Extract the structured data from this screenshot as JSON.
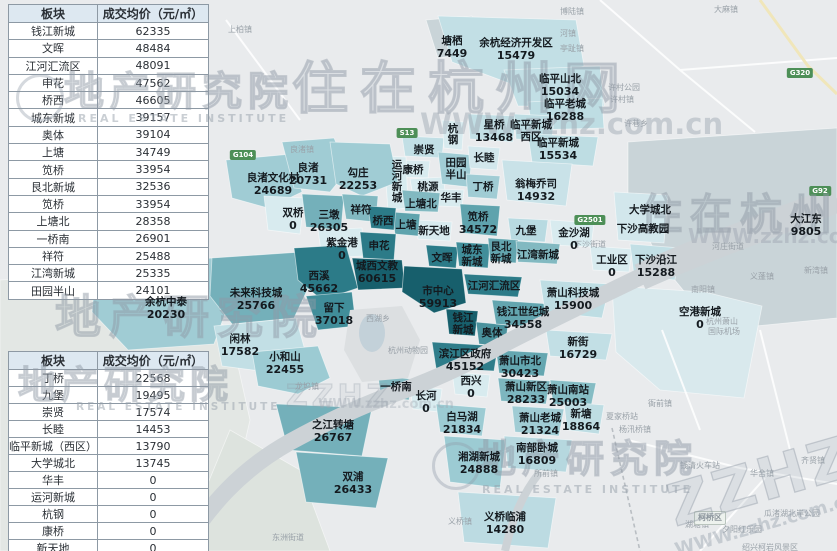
{
  "watermark": {
    "brand_cn": "住在杭州网",
    "brand_abbr": "ZZHZ",
    "brand_url": "WWW.zzhz.com.cn",
    "institute_cn": "地产研究院",
    "institute_en": "REAL ESTATE INSTITUTE"
  },
  "price_tables": [
    {
      "headers": [
        "板块",
        "成交均价（元/㎡）"
      ],
      "rows": [
        [
          "钱江新城",
          "62335"
        ],
        [
          "文晖",
          "48484"
        ],
        [
          "江河汇流区",
          "48091"
        ],
        [
          "申花",
          "47562"
        ],
        [
          "桥西",
          "46605"
        ],
        [
          "城东新城",
          "39157"
        ],
        [
          "奥体",
          "39104"
        ],
        [
          "上塘",
          "34749"
        ],
        [
          "笕桥",
          "33954"
        ],
        [
          "艮北新城",
          "32536"
        ],
        [
          "笕桥",
          "33954"
        ],
        [
          "上塘北",
          "28358"
        ],
        [
          "一桥南",
          "26901"
        ],
        [
          "祥符",
          "25488"
        ],
        [
          "江湾新城",
          "25335"
        ],
        [
          "田园半山",
          "24101"
        ]
      ]
    },
    {
      "headers": [
        "板块",
        "成交均价（元/㎡）"
      ],
      "rows": [
        [
          "丁桥",
          "22568"
        ],
        [
          "九堡",
          "19495"
        ],
        [
          "崇贤",
          "17574"
        ],
        [
          "长睦",
          "14453"
        ],
        [
          "临平新城（西区）",
          "13790"
        ],
        [
          "大学城北",
          "13745"
        ],
        [
          "华丰",
          "0"
        ],
        [
          "运河新城",
          "0"
        ],
        [
          "杭钢",
          "0"
        ],
        [
          "康桥",
          "0"
        ],
        [
          "新天地",
          "0"
        ],
        [
          "桃源",
          "0"
        ]
      ]
    }
  ],
  "map_labels": [
    {
      "n": "塘栖",
      "v": "7449",
      "x": 452,
      "y": 36
    },
    {
      "n": "余杭经济开发区",
      "v": "15479",
      "x": 516,
      "y": 38
    },
    {
      "n": "临平山北",
      "v": "15034",
      "x": 560,
      "y": 74
    },
    {
      "n": "临平老城",
      "v": "16288",
      "x": 565,
      "y": 99
    },
    {
      "n": "星桥",
      "v": "13468",
      "x": 494,
      "y": 120
    },
    {
      "n": "临平新城",
      "n2": "西区",
      "x": 531,
      "y": 120
    },
    {
      "n": "临平新城",
      "v": "15534",
      "x": 558,
      "y": 138
    },
    {
      "n": "翁梅乔司",
      "v": "14932",
      "x": 536,
      "y": 179
    },
    {
      "n": "崇贤",
      "x": 424,
      "y": 145
    },
    {
      "n": "杭钢",
      "vert": true,
      "x": 447,
      "y": 124
    },
    {
      "n": "田园",
      "n2": "半山",
      "x": 456,
      "y": 158
    },
    {
      "n": "长睦",
      "x": 484,
      "y": 153
    },
    {
      "n": "康桥",
      "x": 413,
      "y": 165
    },
    {
      "n": "桃源",
      "x": 428,
      "y": 182
    },
    {
      "n": "运河新城",
      "vert": true,
      "x": 391,
      "y": 160
    },
    {
      "n": "上塘北",
      "x": 421,
      "y": 199
    },
    {
      "n": "华丰",
      "x": 451,
      "y": 193
    },
    {
      "n": "丁桥",
      "x": 483,
      "y": 182
    },
    {
      "n": "上塘",
      "x": 406,
      "y": 220
    },
    {
      "n": "新天地",
      "x": 434,
      "y": 226
    },
    {
      "n": "笕桥",
      "v": "34572",
      "x": 478,
      "y": 212
    },
    {
      "n": "双桥",
      "v": "0",
      "x": 293,
      "y": 208
    },
    {
      "n": "三墩",
      "v": "26305",
      "x": 329,
      "y": 210
    },
    {
      "n": "祥符",
      "x": 361,
      "y": 205
    },
    {
      "n": "桥西",
      "x": 383,
      "y": 216
    },
    {
      "n": "紫金港",
      "v": "0",
      "x": 342,
      "y": 238
    },
    {
      "n": "申花",
      "x": 379,
      "y": 241
    },
    {
      "n": "良渚文化村",
      "v": "24689",
      "x": 273,
      "y": 173
    },
    {
      "n": "良渚",
      "v": "20731",
      "x": 308,
      "y": 163
    },
    {
      "n": "勾庄",
      "v": "22253",
      "x": 358,
      "y": 168
    },
    {
      "n": "西溪",
      "v": "45662",
      "x": 319,
      "y": 271
    },
    {
      "n": "城西文教",
      "v": "60615",
      "x": 377,
      "y": 261
    },
    {
      "n": "文晖",
      "x": 442,
      "y": 253
    },
    {
      "n": "城东",
      "n2": "新城",
      "x": 472,
      "y": 245
    },
    {
      "n": "艮北",
      "n2": "新城",
      "x": 501,
      "y": 242
    },
    {
      "n": "江湾新城",
      "x": 538,
      "y": 250
    },
    {
      "n": "九堡",
      "x": 526,
      "y": 226
    },
    {
      "n": "金沙湖",
      "v": "0",
      "x": 574,
      "y": 228
    },
    {
      "n": "市中心",
      "v": "59913",
      "x": 438,
      "y": 286
    },
    {
      "n": "江河汇流区",
      "x": 494,
      "y": 281
    },
    {
      "n": "大学城北",
      "x": 650,
      "y": 205
    },
    {
      "n": "下沙高教园",
      "x": 643,
      "y": 224
    },
    {
      "n": "工业区",
      "v": "0",
      "x": 612,
      "y": 255
    },
    {
      "n": "下沙沿江",
      "v": "15288",
      "x": 656,
      "y": 255
    },
    {
      "n": "大江东",
      "v": "9805",
      "x": 806,
      "y": 214
    },
    {
      "n": "未来科技城",
      "v": "25766",
      "x": 256,
      "y": 288
    },
    {
      "n": "余杭中泰",
      "v": "20230",
      "x": 166,
      "y": 297
    },
    {
      "n": "留下",
      "v": "37018",
      "x": 334,
      "y": 303
    },
    {
      "n": "闲林",
      "v": "17582",
      "x": 240,
      "y": 334
    },
    {
      "n": "小和山",
      "v": "22455",
      "x": 285,
      "y": 352
    },
    {
      "n": "钱江",
      "n2": "新城",
      "x": 463,
      "y": 313
    },
    {
      "n": "奥体",
      "x": 492,
      "y": 328
    },
    {
      "n": "钱江世纪城",
      "v": "34558",
      "x": 523,
      "y": 307
    },
    {
      "n": "萧山科技城",
      "v": "15900",
      "x": 573,
      "y": 288
    },
    {
      "n": "滨江区政府",
      "v": "45152",
      "x": 465,
      "y": 349
    },
    {
      "n": "新街",
      "v": "16729",
      "x": 578,
      "y": 337
    },
    {
      "n": "萧山市北",
      "v": "30423",
      "x": 520,
      "y": 356
    },
    {
      "n": "西兴",
      "v": "0",
      "x": 471,
      "y": 376
    },
    {
      "n": "一桥南",
      "x": 396,
      "y": 382
    },
    {
      "n": "长河",
      "v": "0",
      "x": 426,
      "y": 391
    },
    {
      "n": "之江转塘",
      "v": "26767",
      "x": 333,
      "y": 420
    },
    {
      "n": "白马湖",
      "v": "21834",
      "x": 462,
      "y": 412
    },
    {
      "n": "萧山新区",
      "v": "28233",
      "x": 526,
      "y": 382
    },
    {
      "n": "萧山南站",
      "v": "25003",
      "x": 568,
      "y": 385
    },
    {
      "n": "萧山老城",
      "v": "21324",
      "x": 540,
      "y": 413
    },
    {
      "n": "新塘",
      "v": "18864",
      "x": 581,
      "y": 409
    },
    {
      "n": "湘湖新城",
      "v": "24888",
      "x": 479,
      "y": 452
    },
    {
      "n": "南部卧城",
      "v": "16809",
      "x": 537,
      "y": 443
    },
    {
      "n": "双浦",
      "v": "26433",
      "x": 353,
      "y": 472
    },
    {
      "n": "义桥临浦",
      "v": "14280",
      "x": 505,
      "y": 512
    },
    {
      "n": "空港新城",
      "v": "0",
      "x": 700,
      "y": 307
    }
  ],
  "base_labels": [
    {
      "t": "上柏镇",
      "x": 240,
      "y": 26
    },
    {
      "t": "博陆镇",
      "x": 572,
      "y": 8
    },
    {
      "t": "大麻镇",
      "x": 726,
      "y": 6
    },
    {
      "t": "河镇",
      "x": 568,
      "y": 30
    },
    {
      "t": "亭趾镇",
      "x": 572,
      "y": 45
    },
    {
      "t": "许村公园",
      "x": 624,
      "y": 84
    },
    {
      "t": "许村镇",
      "x": 622,
      "y": 96
    },
    {
      "t": "许巷乡",
      "x": 636,
      "y": 120
    },
    {
      "t": "良渚镇",
      "x": 302,
      "y": 146
    },
    {
      "t": "下沙街道",
      "x": 590,
      "y": 241
    },
    {
      "t": "河庄街道",
      "x": 728,
      "y": 243
    },
    {
      "t": "义蓬镇",
      "x": 762,
      "y": 273
    },
    {
      "t": "新湾镇",
      "x": 816,
      "y": 267
    },
    {
      "t": "南阳镇",
      "x": 703,
      "y": 286
    },
    {
      "t": "杭州萧山",
      "x": 722,
      "y": 318
    },
    {
      "t": "国际机场",
      "x": 724,
      "y": 328
    },
    {
      "t": "西湖乡",
      "x": 378,
      "y": 315
    },
    {
      "t": "杭州动物园",
      "x": 408,
      "y": 347
    },
    {
      "t": "龙坞镇",
      "x": 307,
      "y": 383
    },
    {
      "t": "东洲街道",
      "x": 288,
      "y": 534
    },
    {
      "t": "义桥镇",
      "x": 460,
      "y": 518
    },
    {
      "t": "所前镇",
      "x": 546,
      "y": 470
    },
    {
      "t": "夏家桥站",
      "x": 622,
      "y": 413
    },
    {
      "t": "衙前镇",
      "x": 660,
      "y": 400
    },
    {
      "t": "杨汛桥镇",
      "x": 635,
      "y": 426
    },
    {
      "t": "钱清火车站",
      "x": 700,
      "y": 462
    },
    {
      "t": "齐贤镇",
      "x": 813,
      "y": 457
    },
    {
      "t": "华舍镇",
      "x": 762,
      "y": 470
    },
    {
      "t": "湖塘镇",
      "x": 697,
      "y": 521
    },
    {
      "t": "夕阳红乐园",
      "x": 742,
      "y": 526
    },
    {
      "t": "瓜渚湖北岸公园",
      "x": 792,
      "y": 510
    },
    {
      "t": "绍兴柯岩风景区",
      "x": 770,
      "y": 544
    }
  ],
  "road_badges": [
    {
      "t": "G104",
      "x": 243,
      "y": 150
    },
    {
      "t": "S13",
      "x": 407,
      "y": 128
    },
    {
      "t": "G2501",
      "x": 590,
      "y": 215
    },
    {
      "t": "G320",
      "x": 800,
      "y": 68
    },
    {
      "t": "G92",
      "x": 820,
      "y": 186
    },
    {
      "t": "柯桥区",
      "x": 710,
      "y": 511,
      "area": true
    }
  ]
}
